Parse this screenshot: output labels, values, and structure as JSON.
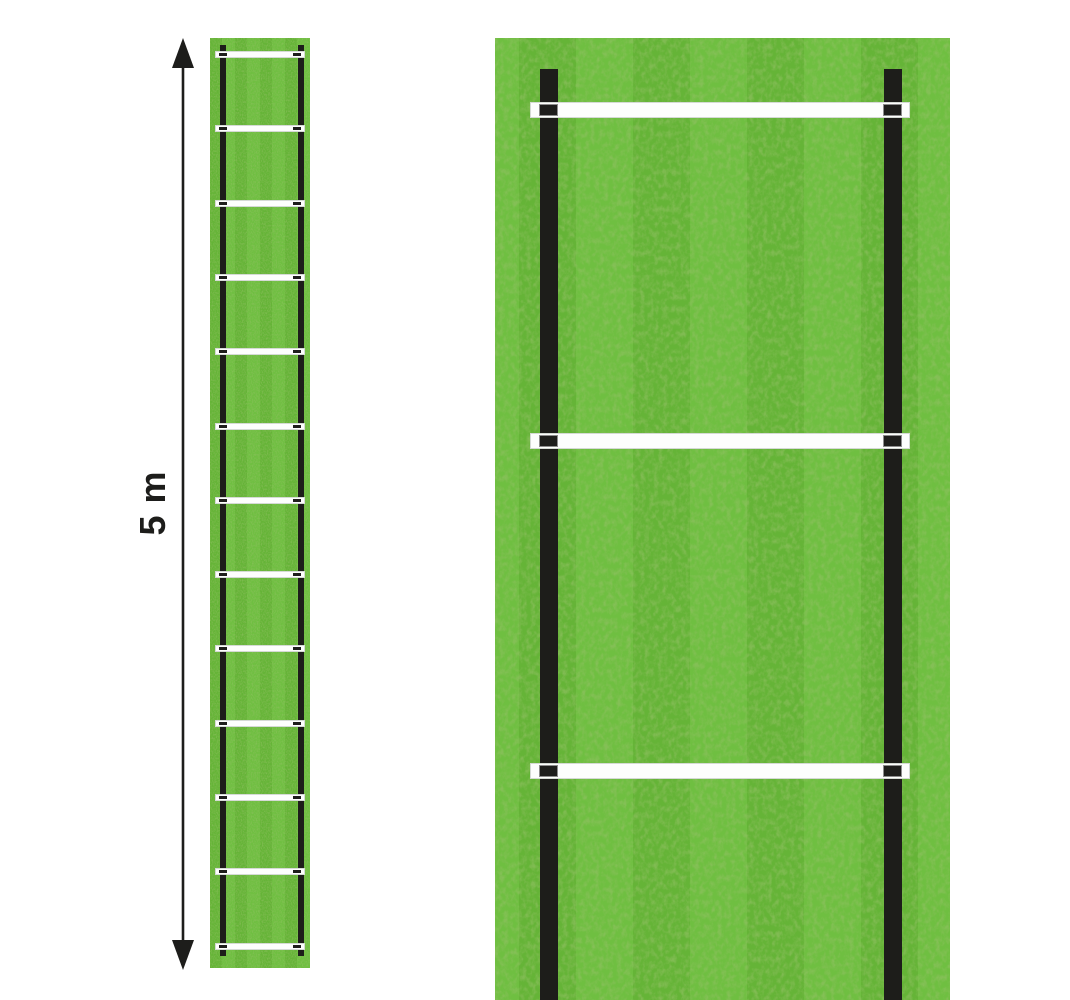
{
  "dimension": {
    "label": "5 m",
    "arrow": "double-headed-vertical"
  },
  "overview_ladder": {
    "description": "agility-ladder-top-view",
    "rung_count": 13,
    "side_rail_count": 2
  },
  "detail_ladder": {
    "description": "agility-ladder-zoomed-section",
    "visible_rung_count": 3,
    "side_rail_count": 2
  },
  "colors": {
    "background": "#ffffff",
    "grass_light": "#6fbf41",
    "grass_dark": "#65b437",
    "grass_texture": "#4a8c24",
    "rail": "#1d1d1a",
    "rung": "#fdfefd",
    "rung_border": "#d5dad5",
    "rung_insert": "#1e1e1c",
    "insert_border": "#8e8e8e",
    "dimension_ink": "#1d1d1b"
  }
}
